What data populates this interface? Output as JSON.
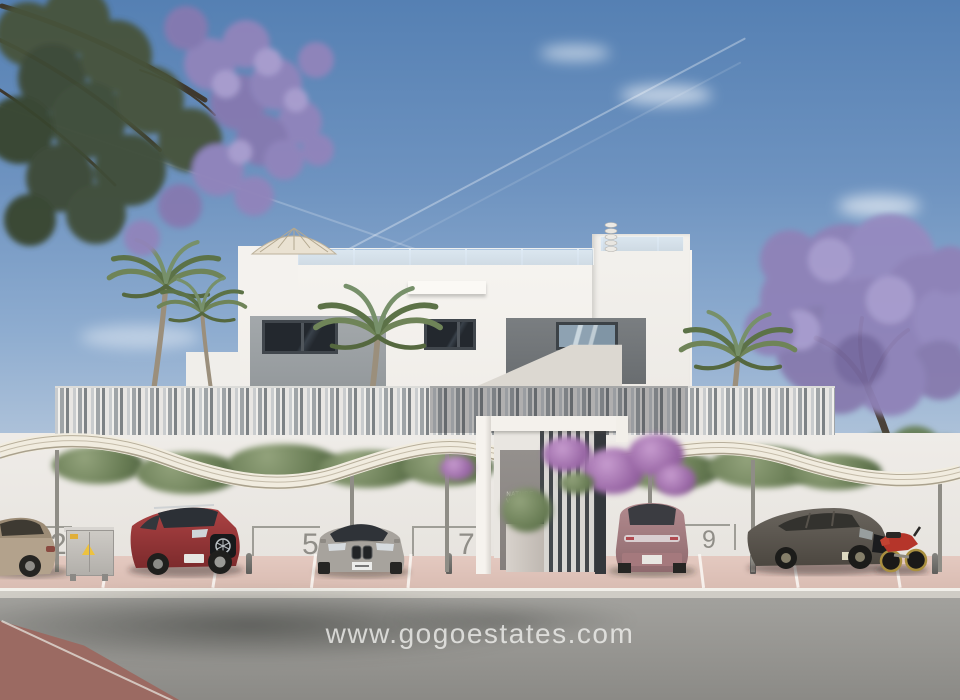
{
  "scene": {
    "kind": "real-estate exterior render",
    "watermark": "www.gogoestates.com",
    "entrance_sign": {
      "line1": "NATURE",
      "line2": "VIEWS 3"
    },
    "parking": {
      "spaces": [
        {
          "number": "2"
        },
        {
          "number": "5"
        },
        {
          "number": "7"
        },
        {
          "number": "9"
        }
      ]
    },
    "palette": {
      "sky_top": "#5580b3",
      "sky_horizon": "#b9cadd",
      "facade_white": "#f4f2ee",
      "panel_gray": "#9aa0a4",
      "jacaranda_purple": "#8f82b8",
      "carport_cream": "#f1ecdf",
      "parking_pink": "#e0c5bc",
      "asphalt_gray": "#9a9995",
      "red_asphalt": "#9b6a62",
      "suv_red": "#a03a3c",
      "sedan_beige": "#b3a28c",
      "sedan_gray": "#a7a39d",
      "suv_mauve": "#b28a8e",
      "wagon_charcoal": "#57524b",
      "motorcycle_red": "#b5352a"
    }
  }
}
